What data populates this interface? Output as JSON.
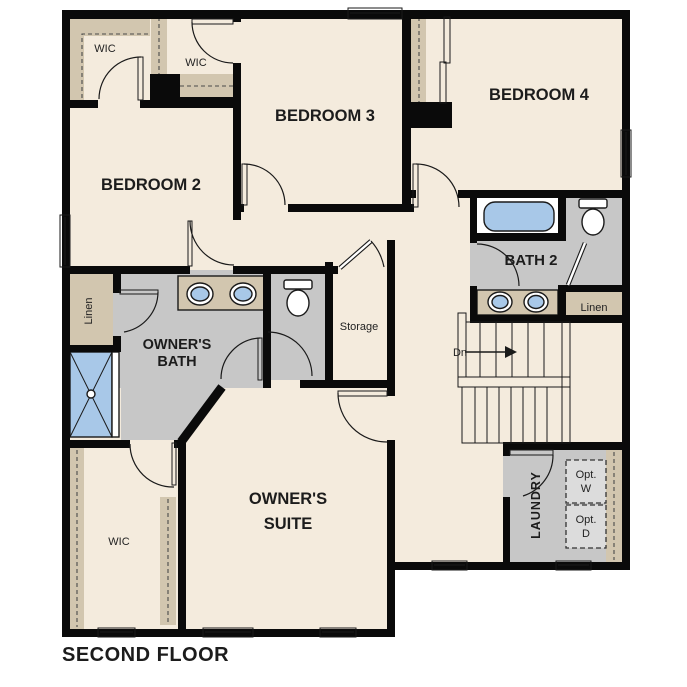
{
  "title": "SECOND FLOOR",
  "rooms": {
    "bedroom2": "BEDROOM 2",
    "bedroom3": "BEDROOM 3",
    "bedroom4": "BEDROOM 4",
    "owners_suite_1": "OWNER'S",
    "owners_suite_2": "SUITE",
    "owners_bath_1": "OWNER'S",
    "owners_bath_2": "BATH",
    "bath2": "BATH 2",
    "laundry": "LAUNDRY",
    "storage": "Storage",
    "wic_bedroom2": "WIC",
    "wic_bedroom3": "WIC",
    "wic_owner": "WIC",
    "linen_owner": "Linen",
    "linen_bath2": "Linen",
    "stairs_down": "Dn",
    "opt_washer_1": "Opt.",
    "opt_washer_2": "W",
    "opt_dryer_1": "Opt.",
    "opt_dryer_2": "D"
  },
  "colors": {
    "wall": "#0a0a0a",
    "floor": "#f4ebdd",
    "bath": "#c7c7c7",
    "tan": "#d2c6af",
    "fixture": "#a8c8e8",
    "optbox": "#dcdcdc",
    "text": "#1c1c1c"
  }
}
